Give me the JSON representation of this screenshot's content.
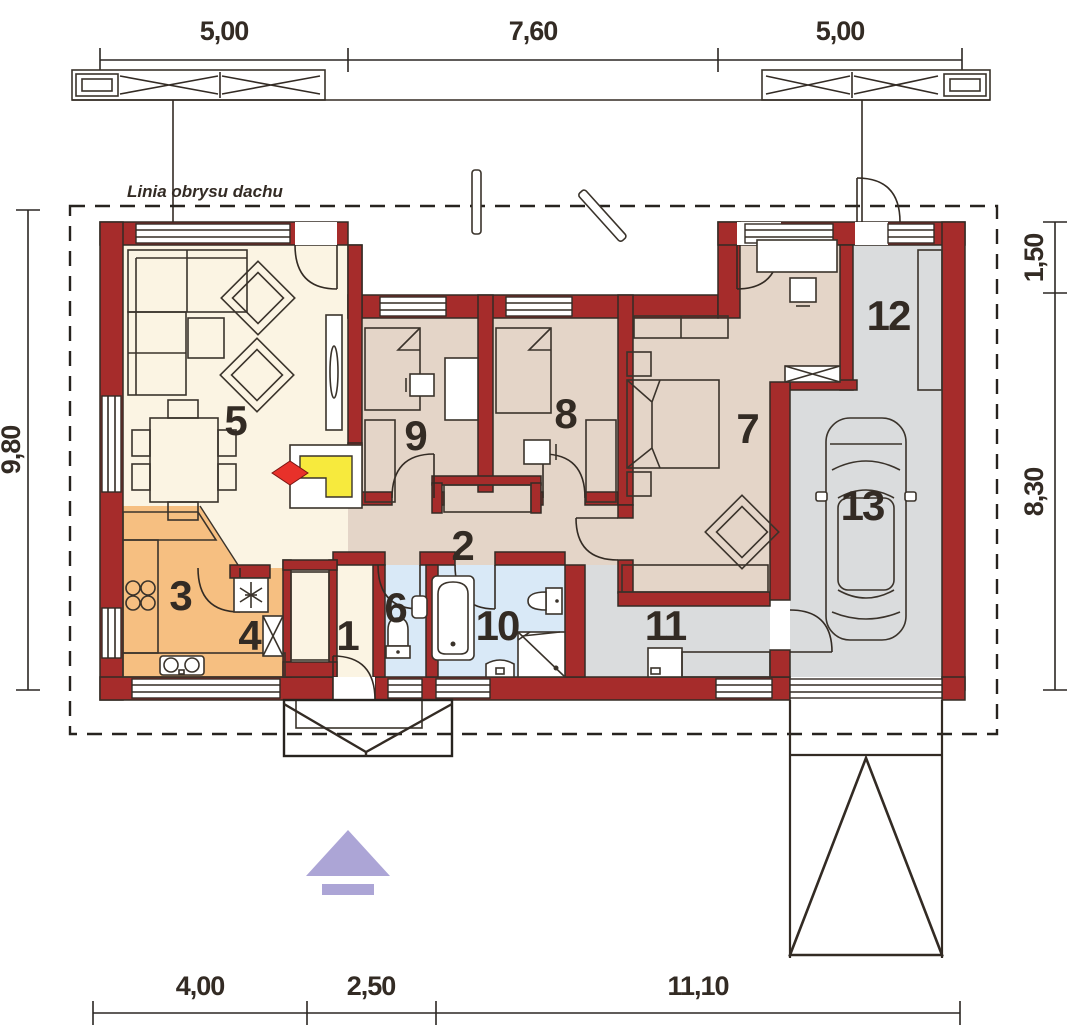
{
  "plan": {
    "roof_label": "Linia obrysu dachu",
    "dims_top": [
      "5,00",
      "7,60",
      "5,00"
    ],
    "dims_bottom": [
      "4,00",
      "2,50",
      "11,10"
    ],
    "dims_left": [
      "9,80"
    ],
    "dims_right": [
      "1,50",
      "8,30"
    ],
    "rooms": [
      {
        "number": "1"
      },
      {
        "number": "2"
      },
      {
        "number": "3"
      },
      {
        "number": "4"
      },
      {
        "number": "5"
      },
      {
        "number": "6"
      },
      {
        "number": "7"
      },
      {
        "number": "8"
      },
      {
        "number": "9"
      },
      {
        "number": "10"
      },
      {
        "number": "11"
      },
      {
        "number": "12"
      },
      {
        "number": "13"
      }
    ],
    "colors": {
      "wall": "#A62C2B",
      "living_cream": "#FBF4E3",
      "bedroom_taupe": "#E4D5C8",
      "kitchen_orange": "#F6BF81",
      "bath_blue": "#D9E9F7",
      "utility_gray": "#DADCDD",
      "fireplace_yellow": "#F7EA3D",
      "flame_red": "#E8312A",
      "arrow_lavender": "#ACA5D6",
      "line": "#332B24"
    }
  }
}
